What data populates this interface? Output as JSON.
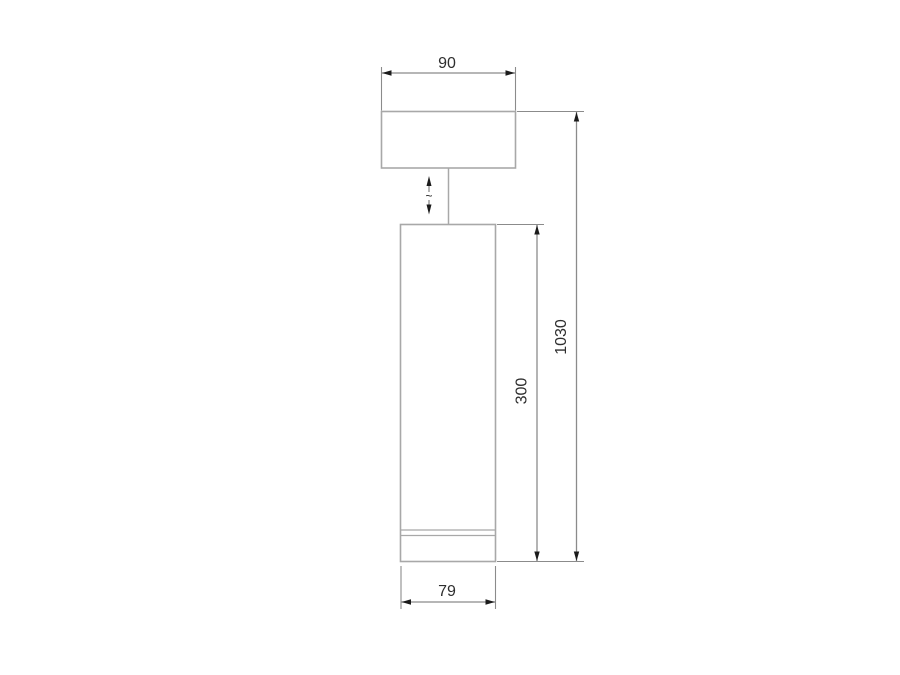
{
  "diagram": {
    "type": "technical-line-drawing",
    "labels": {
      "canopy_width_mm": "90",
      "overall_height_mm": "1030",
      "body_height_mm": "300",
      "body_width_mm": "79",
      "adjustable_glyph": "~"
    },
    "colors": {
      "outline": "#a8a8a8",
      "dimension": "#8b8b8b",
      "arrow": "#1b1b1b",
      "text": "#2e2e2e",
      "background": "#ffffff"
    }
  }
}
